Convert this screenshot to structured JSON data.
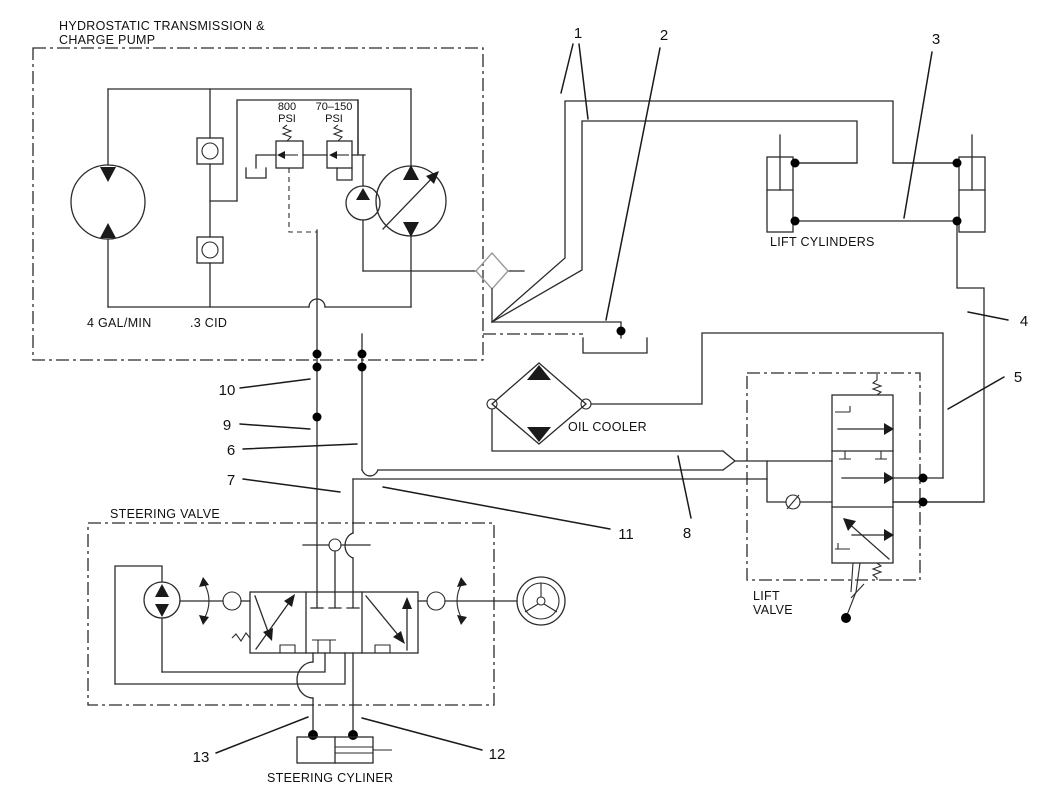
{
  "title": {
    "line1": "HYDROSTATIC TRANSMISSION &",
    "line2": "CHARGE PUMP"
  },
  "labels": {
    "relief_main_pressure": "800",
    "relief_main_unit": "PSI",
    "relief_charge_pressure": "70–150",
    "relief_charge_unit": "PSI",
    "flow_rating": "4 GAL/MIN",
    "displacement_rating": ".3 CID",
    "lift_cylinders": "LIFT CYLINDERS",
    "oil_cooler": "OIL COOLER",
    "lift_valve_line1": "LIFT",
    "lift_valve_line2": "VALVE",
    "steering_valve": "STEERING VALVE",
    "steering_cylinder": "STEERING CYLINER"
  },
  "callouts": [
    "1",
    "2",
    "3",
    "4",
    "5",
    "6",
    "7",
    "8",
    "9",
    "10",
    "11",
    "12",
    "13"
  ]
}
